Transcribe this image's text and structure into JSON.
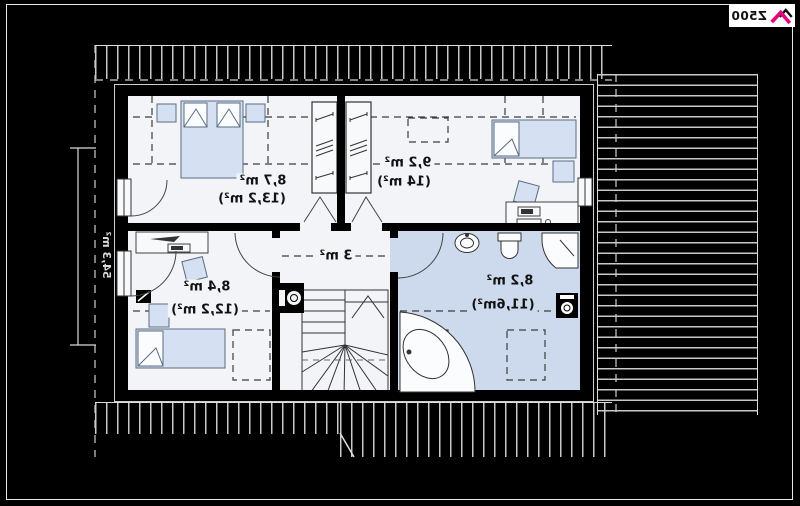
{
  "page": {
    "background_color": "#000000",
    "frame_color": "#e8e8e8"
  },
  "rendering": {
    "mirrored_horizontally": true
  },
  "logo": {
    "text": "Z500",
    "icon": "roof-logo-icon",
    "accent_color": "#e5007d"
  },
  "plan": {
    "type": "attic-floor-plan",
    "side_dimension_label": "54,3 m²",
    "rooms": [
      {
        "name": "bedroom-top-left",
        "area": "8,7 m²",
        "floor_area": "(13,2 m²)"
      },
      {
        "name": "bedroom-top-right",
        "area": "9,2 m²",
        "floor_area": "(14 m²)"
      },
      {
        "name": "hall",
        "area": "3 m²",
        "floor_area": ""
      },
      {
        "name": "bedroom-bottom-left",
        "area": "8,4 m²",
        "floor_area": "(12,2 m²)"
      },
      {
        "name": "bathroom",
        "area": "8,2 m²",
        "floor_area": "(11,6m²)"
      }
    ],
    "fixtures": [
      "double-bed",
      "single-bed",
      "wardrobe",
      "desk-with-computer",
      "office-chair",
      "nightstand",
      "winder-stairs",
      "chimney-flue",
      "corner-bathtub",
      "shower",
      "toilet",
      "sink",
      "washing-machine",
      "radiator",
      "window",
      "door-swing"
    ],
    "colors": {
      "room_fill": "#f2f4f7",
      "bathroom_fill": "#cdd9ec",
      "furniture_fill": "#d5e1f2",
      "furniture_stroke": "#5a6b80",
      "wall_color": "#000000",
      "hatch_line": "#c9c9c9",
      "dashed_line": "#3c3c3c"
    }
  }
}
